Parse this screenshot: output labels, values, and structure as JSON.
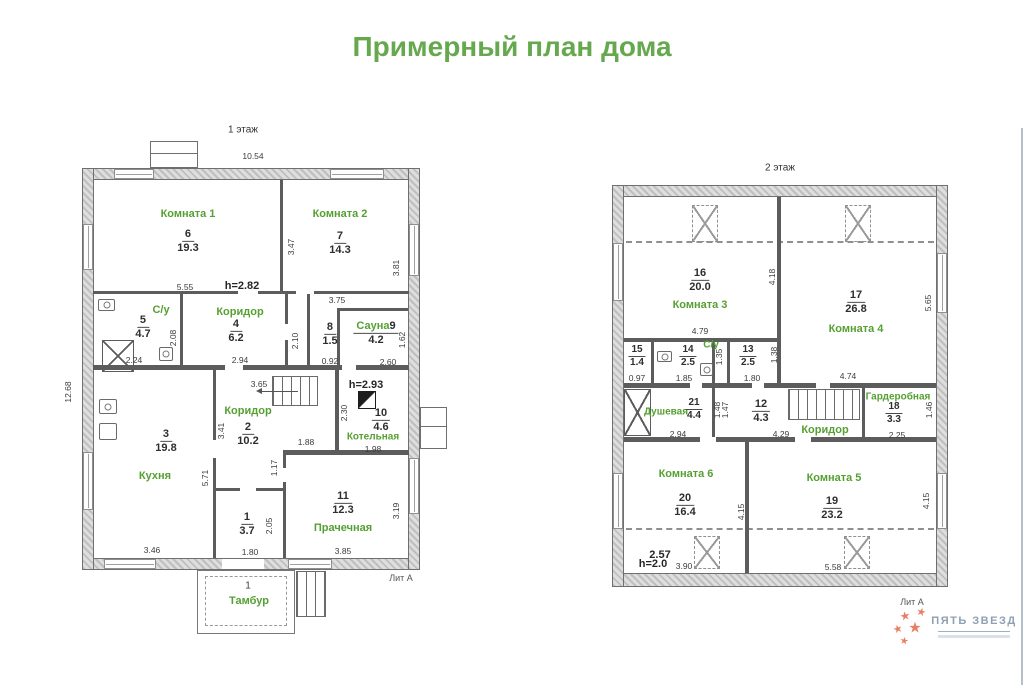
{
  "title": "Примерный план дома",
  "logo": {
    "brand": "ПЯТЬ ЗВЕЗД",
    "star_icon": "★"
  },
  "floor1": {
    "label": "1 этаж",
    "lit": "Лит А",
    "width": "10.54",
    "height": "12.68",
    "rooms": {
      "k1": {
        "name": "Комната 1",
        "num": "6",
        "area": "19.3",
        "w": "5.55",
        "h": "3.47",
        "ceiling": "h=2.82"
      },
      "k2": {
        "name": "Комната 2",
        "num": "7",
        "area": "14.3",
        "w": "3.75",
        "h": "3.81"
      },
      "su": {
        "name": "С/у",
        "num": "5",
        "area": "4.7",
        "w": "2.24",
        "h": "2.08"
      },
      "kor4": {
        "name": "Коридор",
        "num": "4",
        "area": "6.2",
        "w": "2.94",
        "h": "2.10"
      },
      "r8": {
        "num": "8",
        "area": "1.5",
        "w": "0.92"
      },
      "sauna": {
        "name": "Сауна",
        "num": "9",
        "area": "4.2",
        "w": "2.60",
        "h": "1.62"
      },
      "kitchen": {
        "name": "Кухня",
        "num": "3",
        "area": "19.8",
        "w": "3.46",
        "h": "5.71",
        "h2": "3.41"
      },
      "kor2": {
        "name": "Коридор",
        "num": "2",
        "area": "10.2",
        "w": "3.65",
        "d1": "1.88",
        "d2": "1.17"
      },
      "boiler": {
        "name": "Котельная",
        "num": "10",
        "area": "4.6",
        "w": "1.98",
        "h": "2.30",
        "ceiling": "h=2.93"
      },
      "r1": {
        "num": "1",
        "area": "3.7",
        "w": "1.80",
        "h": "2.05"
      },
      "laundry": {
        "name": "Прачечная",
        "num": "11",
        "area": "12.3",
        "w": "3.85",
        "h": "3.19"
      },
      "tambour": {
        "name": "Тамбур",
        "num": "1"
      }
    }
  },
  "floor2": {
    "label": "2 этаж",
    "lit": "Лит А",
    "rooms": {
      "k3": {
        "name": "Комната 3",
        "num": "16",
        "area": "20.0",
        "w": "4.79",
        "h": "4.18"
      },
      "k4": {
        "name": "Комната 4",
        "num": "17",
        "area": "26.8",
        "w": "4.74",
        "h": "5.65"
      },
      "r15": {
        "num": "15",
        "area": "1.4",
        "w": "0.97"
      },
      "su": {
        "name": "С/у",
        "num": "14",
        "area": "2.5",
        "w": "1.85",
        "h": "1.35"
      },
      "r13": {
        "num": "13",
        "area": "2.5",
        "w": "1.80",
        "h": "1.38"
      },
      "shower": {
        "name": "Душевая",
        "num": "21",
        "area": "4.4",
        "w": "2.94",
        "d1": "1.48",
        "d2": "1.47"
      },
      "r12": {
        "num": "12",
        "area": "4.3",
        "w": "4.29"
      },
      "corridor": {
        "name": "Коридор"
      },
      "wardrobe": {
        "name": "Гардеробная",
        "num": "18",
        "area": "3.3",
        "w": "2.25",
        "h": "1.46"
      },
      "k6": {
        "name": "Комната 6",
        "num": "20",
        "area": "16.4",
        "w": "3.90",
        "h": "4.15"
      },
      "k5": {
        "name": "Комната 5",
        "num": "19",
        "area": "23.2",
        "w": "5.58",
        "h": "4.15"
      },
      "slope": {
        "d": "2.57",
        "ceiling": "h=2.0"
      }
    }
  }
}
